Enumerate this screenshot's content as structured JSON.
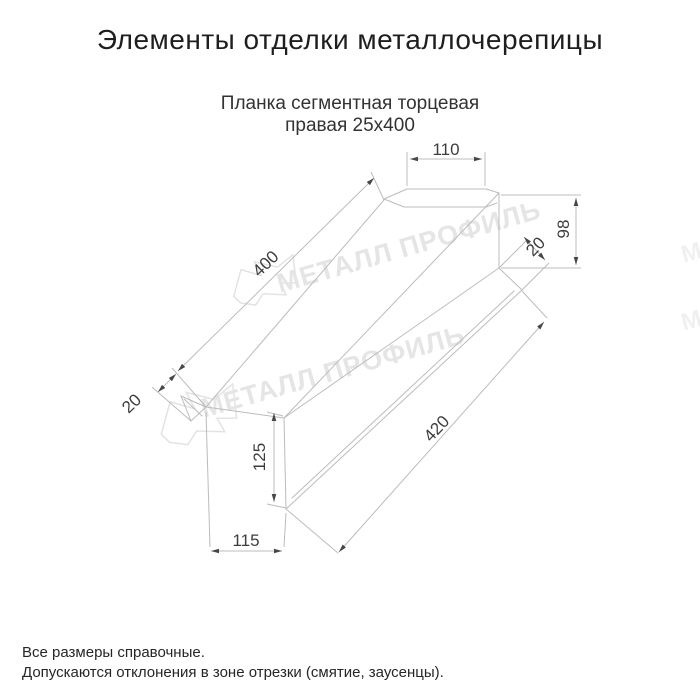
{
  "header": {
    "title": "Элементы отделки металлочерепицы"
  },
  "product": {
    "name_line1": "Планка сегментная торцевая",
    "name_line2": "правая 25х400"
  },
  "dimensions": {
    "top_flange_width": "110",
    "end_height": "98",
    "end_lip": "20",
    "top_edge_length": "400",
    "left_lip": "20",
    "left_height": "125",
    "bottom_offset": "115",
    "bottom_edge_length": "420"
  },
  "watermark": {
    "text": "МЕТАЛЛ ПРОФИЛЬ"
  },
  "footer": {
    "note1": "Все размеры справочные.",
    "note2": "Допускаются отклонения в зоне отрезки (смятие, заусенцы)."
  },
  "colors": {
    "drawing_line": "#bcbcbc",
    "dimension_text": "#3d3d3d",
    "arrowhead": "#474747",
    "watermark": "#e5e5e5",
    "title_text": "#1e1e1e"
  }
}
